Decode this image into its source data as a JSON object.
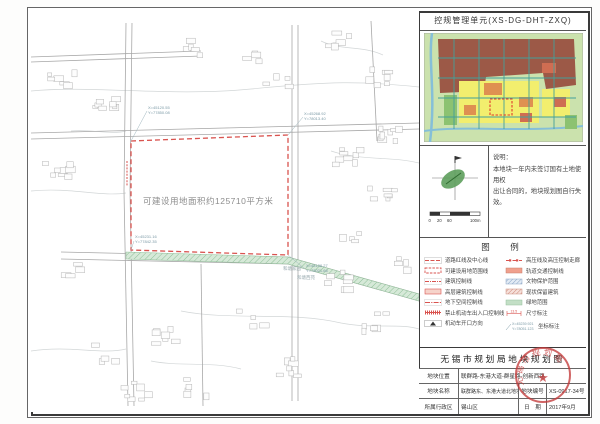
{
  "header": {
    "unit_label": "控规管理单元(XS-DG-DHT-ZXQ)"
  },
  "notes": {
    "heading": "说明：",
    "line1": "本地块一年内未签订国有土地使用权",
    "line2": "出让合同的，地块规划图自行失效。",
    "scale": {
      "t0": "0",
      "t1": "20",
      "t2": "60",
      "t3": "100m"
    }
  },
  "legend": {
    "title": "图　例",
    "left": [
      {
        "label": "道路红线及中心线"
      },
      {
        "label": "可建设用地范围线"
      },
      {
        "label": "建筑控制线"
      },
      {
        "label": "高层建筑控制线"
      },
      {
        "label": "地下空间控制线"
      },
      {
        "label": "禁止机动车出入口控制线"
      },
      {
        "label": "机动车开口方向"
      }
    ],
    "right": [
      {
        "label": "高压线及高压控制走廊"
      },
      {
        "label": "轨道交通控制线"
      },
      {
        "label": "文物保护范围"
      },
      {
        "label": "现状保留建筑"
      },
      {
        "label": "绿地范围"
      },
      {
        "label": "尺寸标注"
      },
      {
        "label": "坐标标注"
      }
    ],
    "dim_sample": "13.5",
    "coord_sample_x": "X=45239.921",
    "coord_sample_y": "Y=78051.123"
  },
  "map": {
    "area_label": "可建设用地面积约125710平方米",
    "corners": [
      {
        "x": "X=45231.16",
        "y": "Y=77842.35"
      },
      {
        "x": "X=45268.92",
        "y": "Y=78013.40"
      },
      {
        "x": "X=45120.55",
        "y": "Y=77850.08"
      },
      {
        "x": "X=45138.27",
        "y": "Y=78021.66"
      }
    ],
    "places": [
      {
        "name": "和塘家园"
      },
      {
        "name": "和塘西苑"
      }
    ]
  },
  "titleblock": {
    "title": "无锡市规划局地块规划图",
    "row1": {
      "label": "地块位置",
      "value": "联群路-东港大道-群星路-创新西路"
    },
    "row2": {
      "label": "地块名称",
      "value": "联群路东、东港大道北地块",
      "label2": "地块编号",
      "value2": "XS-0917-34号"
    },
    "row3": {
      "label": "所属行政区",
      "value": "锡山区",
      "label2": "日　期",
      "value2": "2017年9月"
    }
  },
  "seal": {
    "org": "无锡市规划局"
  },
  "colors": {
    "parcel_red": "#d9534f",
    "seal_red": "#c43b3b",
    "green_strip": "#c3dfc6",
    "minimap_teal": "#43a09a"
  }
}
